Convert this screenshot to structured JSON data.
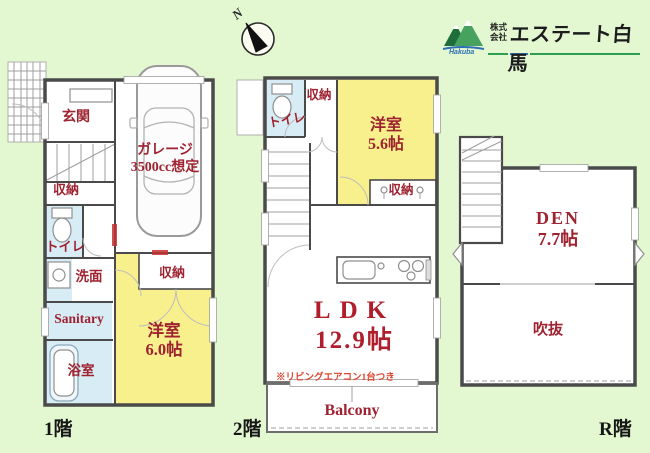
{
  "colors": {
    "bg-green": "#e3f8d1",
    "room-yellow": "#f8f08c",
    "room-blue": "#d7ecf5",
    "label-red": "#9e2230",
    "ldk-red": "#b01e2c",
    "note-orange": "#dc4530",
    "floor-label-black": "#161616",
    "logo-green": "#2e9e4f",
    "logo-blue": "#2f6fb5"
  },
  "compass": {
    "label": "N"
  },
  "logo": {
    "prefix_line1": "株式",
    "prefix_line2": "会社",
    "company": "エステート白馬",
    "sub": "Hakuba"
  },
  "floors": {
    "f1": {
      "label": "1階",
      "rooms": {
        "genkan": "玄関",
        "garage_l1": "ガレージ",
        "garage_l2": "3500cc想定",
        "shuno_a": "収納",
        "toilet": "トイレ",
        "senmen": "洗面",
        "sanitary": "Sanitary",
        "yokushitsu": "浴室",
        "shuno_b": "収納",
        "yoshitsu_l1": "洋室",
        "yoshitsu_l2": "6.0帖"
      }
    },
    "f2": {
      "label": "2階",
      "rooms": {
        "shuno_top": "収納",
        "toilet": "トイレ",
        "yoshitsu_l1": "洋室",
        "yoshitsu_l2": "5.6帖",
        "shuno_bottom": "収納",
        "ldk_l1": "LDK",
        "ldk_l2": "12.9帖",
        "aircon_note": "※リビングエアコン1台つき",
        "balcony": "Balcony"
      }
    },
    "fr": {
      "label": "R階",
      "rooms": {
        "den_l1": "DEN",
        "den_l2": "7.7帖",
        "fukinuke": "吹抜"
      }
    }
  }
}
